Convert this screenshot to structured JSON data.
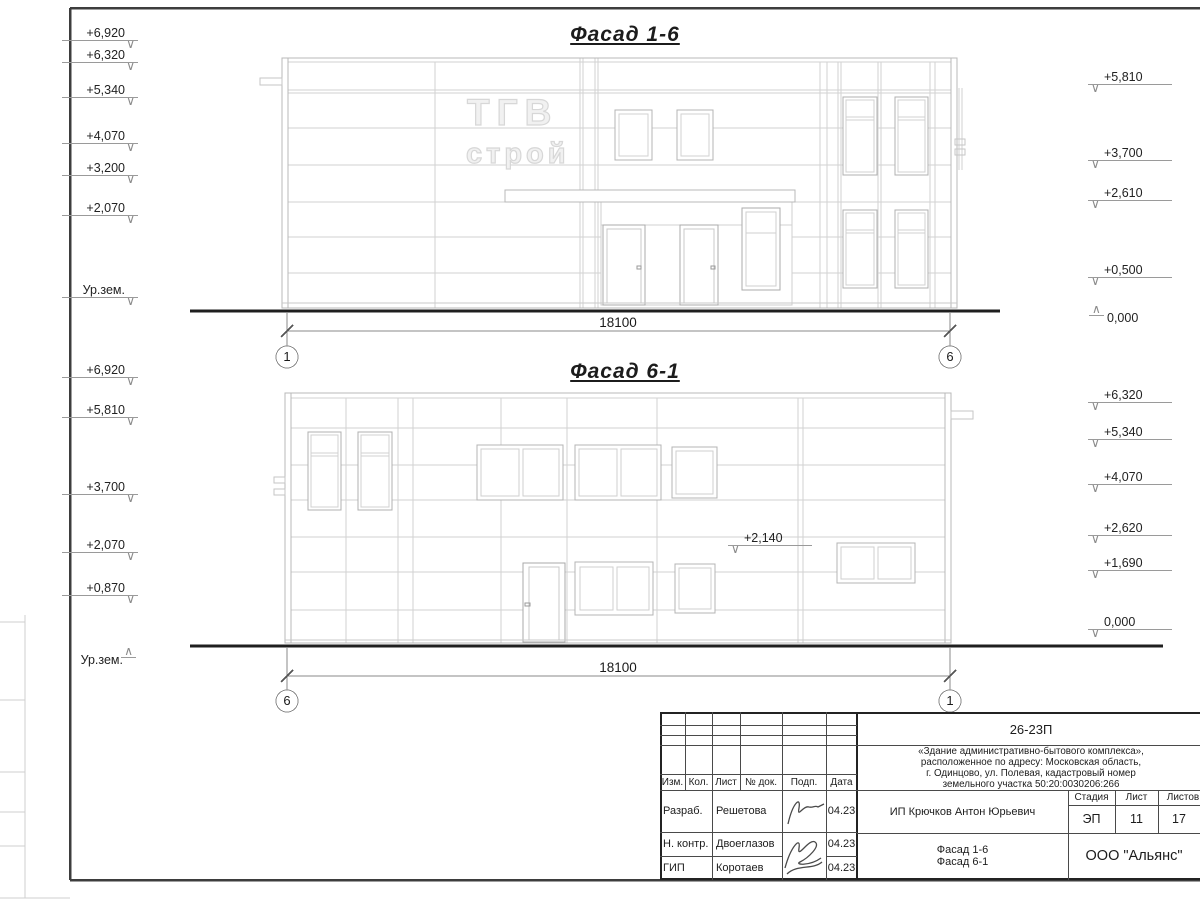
{
  "facade_top": {
    "title": "Фасад 1-6",
    "logo": {
      "line1": "ТГВ",
      "line2": "строй"
    },
    "elev_left": [
      "+6,920",
      "+6,320",
      "+5,340",
      "+4,070",
      "+3,200",
      "+2,070",
      "Ур.зем."
    ],
    "elev_right": [
      "+5,810",
      "+3,700",
      "+2,610",
      "+0,500",
      "0,000"
    ],
    "dimension": "18100",
    "axis_left": "1",
    "axis_right": "6"
  },
  "facade_bottom": {
    "title": "Фасад 6-1",
    "elev_left": [
      "+6,920",
      "+5,810",
      "+3,700",
      "+2,070",
      "+0,870",
      "Ур.зем."
    ],
    "elev_right": [
      "+6,320",
      "+5,340",
      "+4,070",
      "+2,620",
      "+1,690",
      "0,000"
    ],
    "mid_elevation": "+2,140",
    "dimension": "18100",
    "axis_left": "6",
    "axis_right": "1"
  },
  "title_block": {
    "doc_code": "26-23П",
    "project_description": "«Здание административно-бытового комплекса»,\nрасположенное по адресу: Московская область,\nг. Одинцово, ул. Полевая, кадастровый номер\nземельного участка 50:20:0030206:266",
    "columns": [
      "Изм.",
      "Кол.",
      "Лист",
      "№ док.",
      "Подп.",
      "Дата"
    ],
    "rows": [
      {
        "role": "Разраб.",
        "name": "Решетова",
        "date": "04.23"
      },
      {
        "role": "Н. контр.",
        "name": "Двоеглазов",
        "date": "04.23"
      },
      {
        "role": "ГИП",
        "name": "Коротаев",
        "date": "04.23"
      }
    ],
    "client": "ИП Крючков Антон Юрьевич",
    "stage_label": "Стадия",
    "sheet_label": "Лист",
    "total_label": "Листов",
    "stage": "ЭП",
    "sheet_number": "11",
    "sheets_total": "17",
    "drawing_title": "Фасад 1-6\nФасад 6-1",
    "company": "ООО \"Альянс\""
  }
}
